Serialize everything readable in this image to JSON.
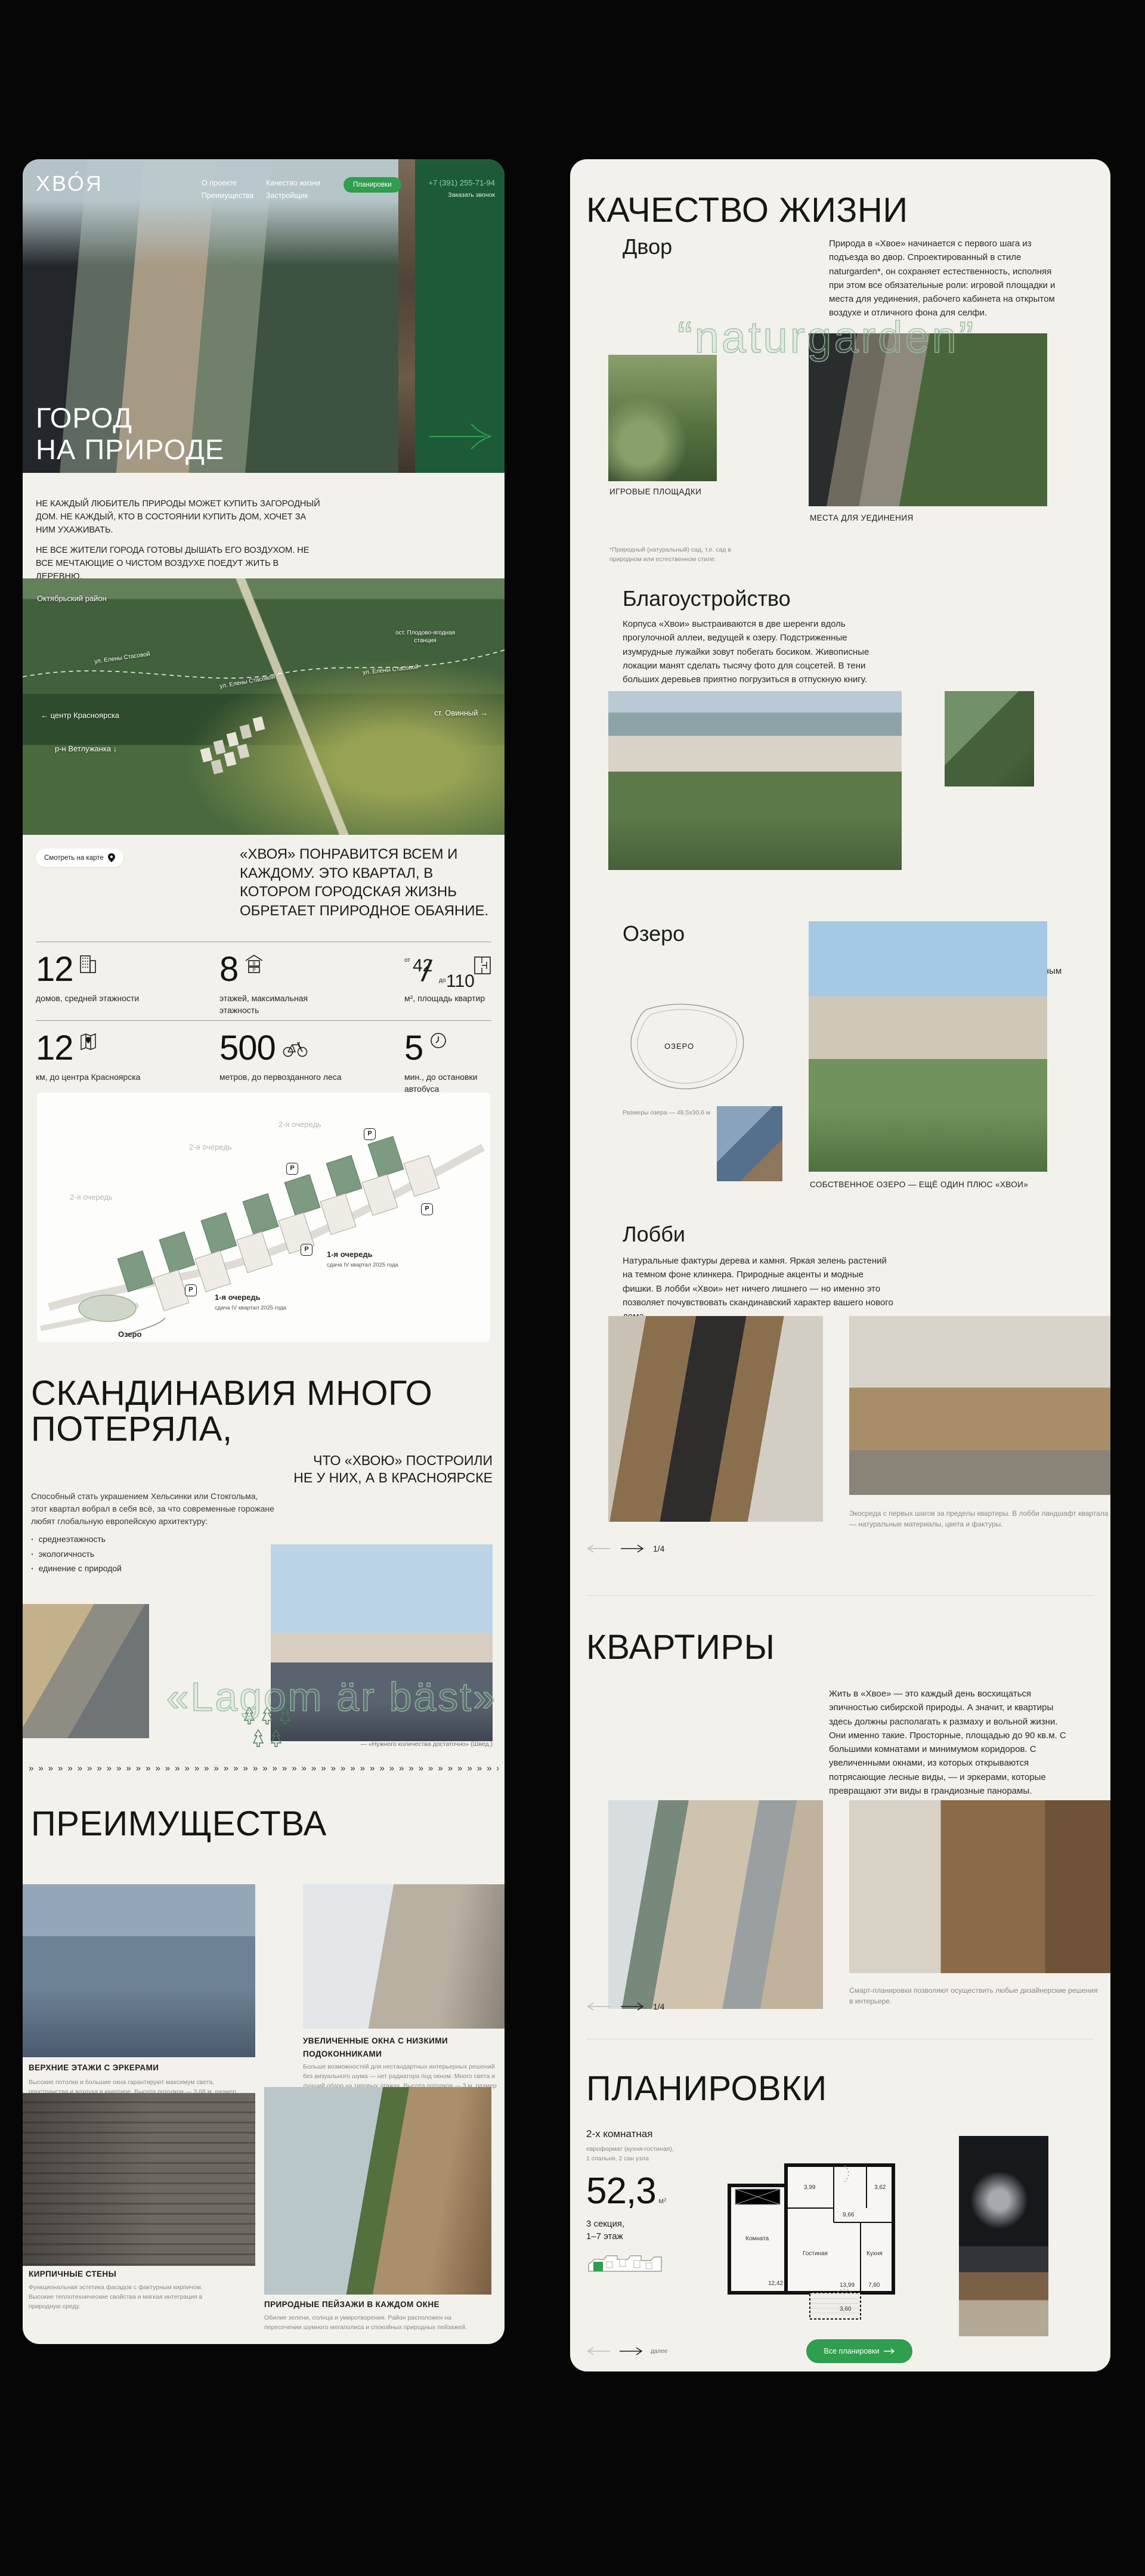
{
  "theme": {
    "accent_green": "#2f9e4f",
    "dark_green": "#1d5b38",
    "panel_bg": "#f2f1ec",
    "text": "#1d1d1b"
  },
  "header": {
    "logo": "ХВО́Я",
    "nav": {
      "item1": "О проекте",
      "item2": "Преимущества",
      "item3": "Качество жизни",
      "item4": "Застройщик"
    },
    "plans_button": "Планировки",
    "phone": "+7 (391) 255-71-94",
    "callback": "Заказать звонок"
  },
  "hero": {
    "title1": "ГОРОД",
    "title2": "НА ПРИРОДЕ"
  },
  "intro": {
    "p1": "НЕ КАЖДЫЙ ЛЮБИТЕЛЬ ПРИРОДЫ МОЖЕТ КУПИТЬ ЗАГОРОДНЫЙ ДОМ. НЕ КАЖДЫЙ, КТО В СОСТОЯНИИ КУПИТЬ ДОМ, ХОЧЕТ ЗА НИМ УХАЖИВАТЬ.",
    "p2": "НЕ ВСЕ ЖИТЕЛИ ГОРОДА ГОТОВЫ ДЫШАТЬ ЕГО ВОЗДУХОМ. НЕ ВСЕ МЕЧТАЮЩИЕ О ЧИСТОМ ВОЗДУХЕ ПОЕДУТ ЖИТЬ В ДЕРЕВНЮ."
  },
  "location_map": {
    "district": "Октябрьский район",
    "street": "ул. Елены Стасовой",
    "stop": "ост. Плодово-ягодная станция",
    "center": "← центр Красноярска",
    "vetluzhanka": "р-н Ветлужанка ↓",
    "ovinny": "ст. Овинный →",
    "link": "Смотреть на карте"
  },
  "quote": "«ХВОЯ» ПОНРАВИТСЯ ВСЕМ И КАЖДОМУ. ЭТО КВАРТАЛ, В КОТОРОМ ГОРОДСКАЯ ЖИЗНЬ ОБРЕТАЕТ ПРИРОДНОЕ ОБАЯНИЕ.",
  "stats": {
    "s1": {
      "value": "12",
      "label": "домов, средней этажности"
    },
    "s2": {
      "value": "8",
      "label": "этажей, максимальная этажность"
    },
    "s3": {
      "from": "от",
      "v1": "42",
      "to": "до",
      "v2": "110",
      "label": "м², площадь квартир"
    },
    "s4": {
      "value": "12",
      "label": "км, до центра Красноярска"
    },
    "s5": {
      "value": "500",
      "label": "метров, до первозданного леса"
    },
    "s6": {
      "value": "5",
      "label": "мин., до остановки автобуса"
    }
  },
  "masterplan": {
    "phase2": "2-я очередь",
    "phase1": "1-я очередь",
    "phase1_note": "сдача IV квартал 2025 года",
    "lake": "Озеро",
    "parking": "P"
  },
  "scandinavia": {
    "title1": "СКАНДИНАВИЯ МНОГО",
    "title2": "ПОТЕРЯЛА,",
    "subtitle1": "ЧТО «ХВОЮ» ПОСТРОИЛИ",
    "subtitle2": "НЕ У НИХ, А В КРАСНОЯРСКЕ",
    "text": "Способный стать украшением Хельсинки или Стокгольма, этот квартал вобрал в себя всё, за что современные горожане любят глобальную европейскую архитектуру:",
    "b1": "среднеэтажность",
    "b2": "экологичность",
    "b3": "единение с природой",
    "watermark": "«Lagom är bäst»",
    "note": "— «Нужного количества достаточно» (Швед.)"
  },
  "zigzag": "»»»»»»»»»»»»»»»»»»»»»»»»»»»»»»»»»»»»»»»»»»»»»»»»»»»»»»»»»»»»»»»»»»»»»»»»»»»»»»»»",
  "advantages": {
    "title": "ПРЕИМУЩЕСТВА",
    "c1": {
      "title": "ВЕРХНИЕ ЭТАЖИ С ЭРКЕРАМИ",
      "text": "Высокие потолки и большие окна гарантируют максимум света, пространства и воздуха в квартире. Высота потолков — 3,68 м, размер окон по ширине 3 м, в высоту — 2,75 м."
    },
    "c2": {
      "title": "УВЕЛИЧЕННЫЕ ОКНА С НИЗКИМИ ПОДОКОННИКАМИ",
      "text": "Больше возможностей для нестандартных интерьерных решений без визуального шума — нет радиатора под окном. Много света и лучший обзор на типовых этажах. Высота потолков — 3 м, размер окон по ширине — 1 м, в высоту — 1,96 м."
    },
    "c3": {
      "title": "КИРПИЧНЫЕ СТЕНЫ",
      "text": "Функциональная эстетика фасадов с фактурным кирпичом. Высокие теплотехнические свойства и мягкая интеграция в природную среду."
    },
    "c4": {
      "title": "ПРИРОДНЫЕ ПЕЙЗАЖИ В КАЖДОМ ОКНЕ",
      "text": "Обилие зелени, солнца и умиротворения. Район расположен на пересечении шумного мегаполиса и спокойных природных пейзажей."
    }
  },
  "quality": {
    "title": "КАЧЕСТВО ЖИЗНИ"
  },
  "yard": {
    "title": "Двор",
    "text": "Природа в «Хвое» начинается с первого шага из подъезда во двор. Спроектированный в стиле naturgarden*, он сохраняет естественность, исполняя при этом все обязательные роли: игровой площадки и места для уединения, рабочего кабинета на открытом воздухе и отличного фона для селфи.",
    "watermark": "“naturgarden”",
    "cap1": "ИГРОВЫЕ ПЛОЩАДКИ",
    "cap2": "МЕСТА ДЛЯ УЕДИНЕНИЯ",
    "footnote": "*Природный (натуральный) сад, т.е. сад в природном или естественном стиле."
  },
  "landscaping": {
    "title": "Благоустройство",
    "text": "Корпуса «Хвои» выстраиваются в две шеренги вдоль прогулочной аллеи, ведущей к озеру. Подстриженные изумрудные лужайки зовут побегать босиком. Живописные локации манят сделать тысячу фото для соцсетей. В тени больших деревьев приятно погрузиться в отпускную книгу."
  },
  "lake": {
    "title": "Озеро",
    "text": "У «Хвои» есть собственное озеро. Украшенное деревянными террасами и пляжной зоной с шезлонгами, оно поделится с вами освежающим ветерком в разгар июльского зноя. И станет природным катком с наступлением крещенских морозов.",
    "sketch_label": "ОЗЕРО",
    "size_note": "Размеры озера — 48,5х30,6 м",
    "caption": "СОБСТВЕННОЕ ОЗЕРО — ЕЩЁ ОДИН ПЛЮС «ХВОИ»"
  },
  "lobby": {
    "title": "Лобби",
    "text": "Натуральные фактуры дерева и камня. Яркая зелень растений на темном фоне клинкера. Природные акценты и модные фишки. В лобби «Хвои» нет ничего лишнего — но именно это позволяет почувствовать скандинавский характер вашего нового дома.",
    "caption": "Экосреда с первых шагов за пределы квартиры. В лобби ландшафт квартала — натуральные материалы, цвета и фактуры.",
    "page": "1/4"
  },
  "apartments": {
    "title": "КВАРТИРЫ",
    "text": "Жить в «Хвое» — это каждый день восхищаться эпичностью сибирской природы. А значит, и квартиры здесь должны располагать к размаху и вольной жизни. Они именно такие. Просторные, площадью до 90 кв.м. С большими комнатами и минимумом коридоров. С увеличенными окнами, из которых открываются потрясающие лесные виды, — и эркерами, которые превращают эти виды в грандиозные панорамы.",
    "caption": "Смарт-планировки позволяют осуществить любые дизайнерские решения в интерьере.",
    "page": "1/4"
  },
  "plans": {
    "title": "ПЛАНИРОВКИ",
    "type": "2-х комнатная",
    "format1": "евроформат (кухня-гостиная),",
    "format2": "1 спальня, 2 сан узла",
    "area": "52,3",
    "unit": "м²",
    "section1": "3 секция,",
    "section2": "1–7 этаж",
    "next": "далее",
    "cta": "Все планировки",
    "rooms": {
      "r1name": "Комната",
      "r1": "12,42",
      "r2name": "Гостиная",
      "r2": "13,99",
      "r3name": "Кухня",
      "r3": "7,60",
      "r4": "9,66",
      "r5": "3,99",
      "r6": "3,62",
      "r7": "3,60"
    }
  }
}
